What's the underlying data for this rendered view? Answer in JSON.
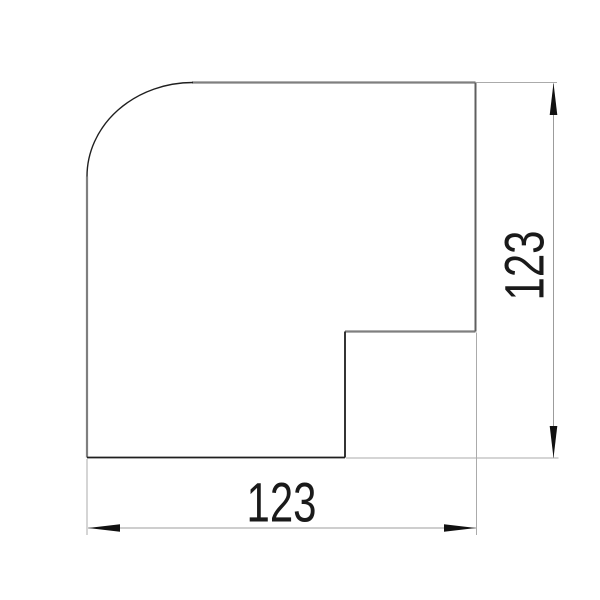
{
  "drawing": {
    "description": "Dimensioned outline of a flat corner piece with rounded outer corner and stepped notch",
    "dim_horizontal": {
      "label": "123"
    },
    "dim_vertical": {
      "label": "123"
    },
    "colors": {
      "background": "#ffffff",
      "outline_gray": "#7f7f7f",
      "outline_right": "#5f5f5f",
      "outline_dark": "#1f1f1f",
      "extension_line": "#ababab",
      "dimension_line": "#9c9c9c",
      "arrow": "#111111",
      "text": "#1a1a1a"
    }
  }
}
